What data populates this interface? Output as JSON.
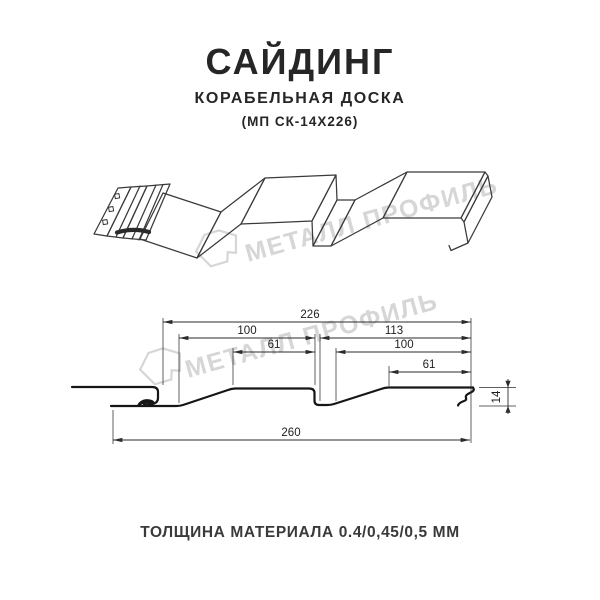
{
  "header": {
    "title": "САЙДИНГ",
    "subtitle": "КОРАБЕЛЬНАЯ ДОСКА",
    "model": "(МП СК-14Х226)"
  },
  "watermark": {
    "brand": "МЕТАЛЛ ПРОФИЛЬ"
  },
  "diagram": {
    "dimensions": {
      "overall_width_top": "226",
      "upper_left": "100",
      "upper_right": "113",
      "mid_left": "61",
      "mid_right": "100",
      "lower_right": "61",
      "profile_height": "14",
      "overall_width_bottom": "260"
    }
  },
  "footer": {
    "thickness_note": "ТОЛЩИНА МАТЕРИАЛА 0.4/0,45/0,5 ММ"
  },
  "colors": {
    "background": "#ffffff",
    "drawing_line": "#3a3a3a",
    "profile_line": "#161616",
    "dimension_line": "#2b2b2b",
    "watermark": "#d6d6d6",
    "text": "#262626"
  }
}
